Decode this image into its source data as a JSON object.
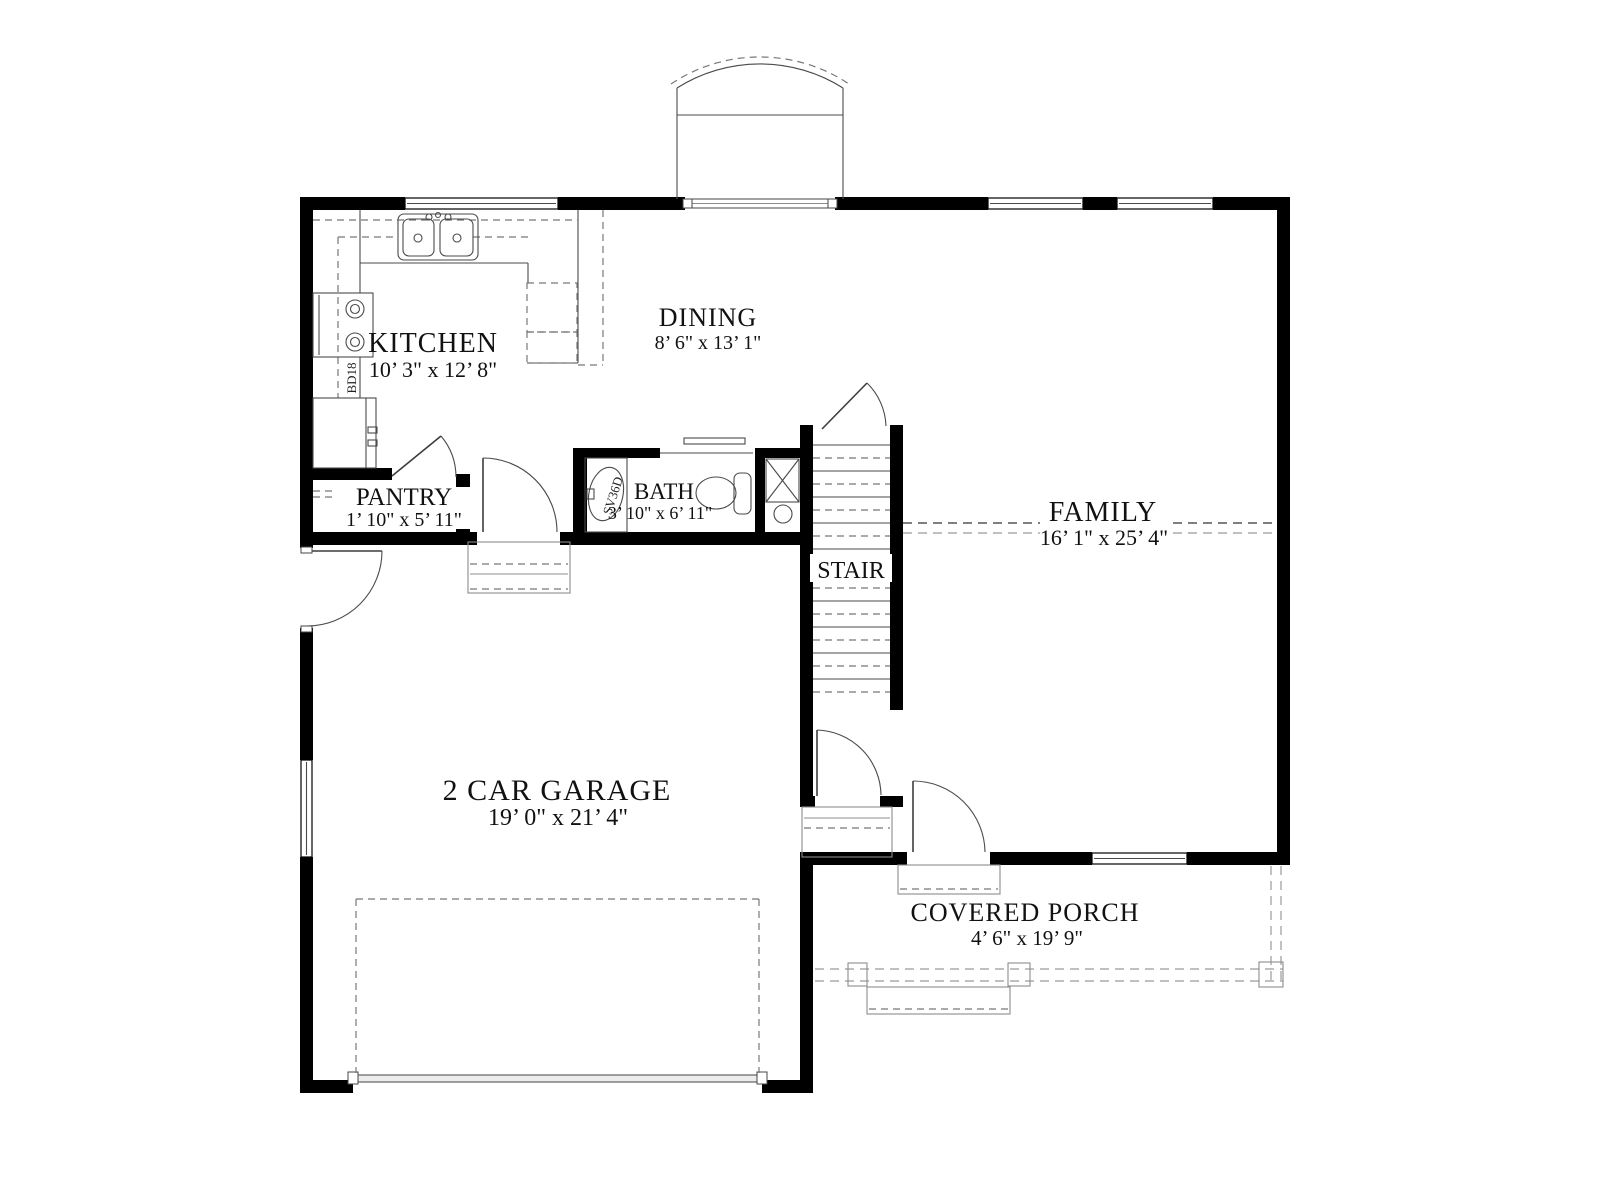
{
  "drawing": {
    "type": "architectural-first-floor-plan",
    "rooms": [
      {
        "id": "kitchen",
        "name": "KITCHEN",
        "dims": "10’ 3\" x 12’ 8\""
      },
      {
        "id": "dining",
        "name": "DINING",
        "dims": "8’ 6\" x 13’ 1\""
      },
      {
        "id": "family",
        "name": "FAMILY",
        "dims": "16’ 1\" x 25’ 4\""
      },
      {
        "id": "pantry",
        "name": "PANTRY",
        "dims": "1’ 10\" x 5’ 11\""
      },
      {
        "id": "bath",
        "name": "BATH",
        "dims": "3’ 10\" x 6’ 11\""
      },
      {
        "id": "stair",
        "name": "STAIR",
        "dims": ""
      },
      {
        "id": "garage",
        "name": "2 CAR GARAGE",
        "dims": "19’ 0\" x 21’ 4\""
      },
      {
        "id": "porch",
        "name": "COVERED PORCH",
        "dims": "4’ 6\" x 19’ 9\""
      }
    ],
    "fixture_labels": {
      "base_cabinet": "BD18",
      "vanity": "SV36D"
    },
    "colors": {
      "wall": "#000000",
      "line": "#3d3d3d",
      "dash_gray": "#8c8c8c",
      "background": "#ffffff",
      "text": "#111111"
    }
  }
}
